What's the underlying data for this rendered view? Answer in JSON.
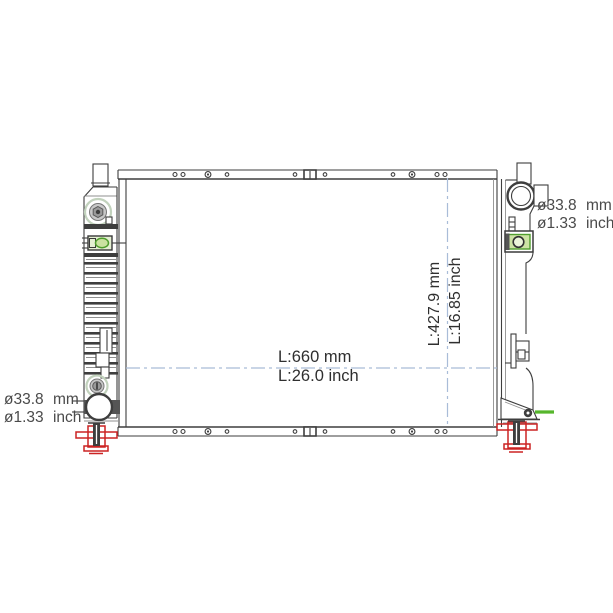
{
  "labels": {
    "width_dim_mm": "L:660 mm",
    "width_dim_inch": "L:26.0 inch",
    "height_dim_mm": "L:427.9 mm",
    "height_dim_inch": "L:16.85 inch",
    "inlet_port_mm": "ø33.8 mm",
    "inlet_port_inch": "ø1.33 inch",
    "outlet_port_mm": "ø33.8 mm",
    "outlet_port_inch": "ø1.33 inch"
  },
  "colors": {
    "line": "#3e3e3e",
    "dimension_line": "#a9bcd8",
    "highlight_red": "#cc2323",
    "highlight_green": "#56b62c",
    "fitting_fill": "#cde3a4",
    "text": "#2f2f2f"
  }
}
